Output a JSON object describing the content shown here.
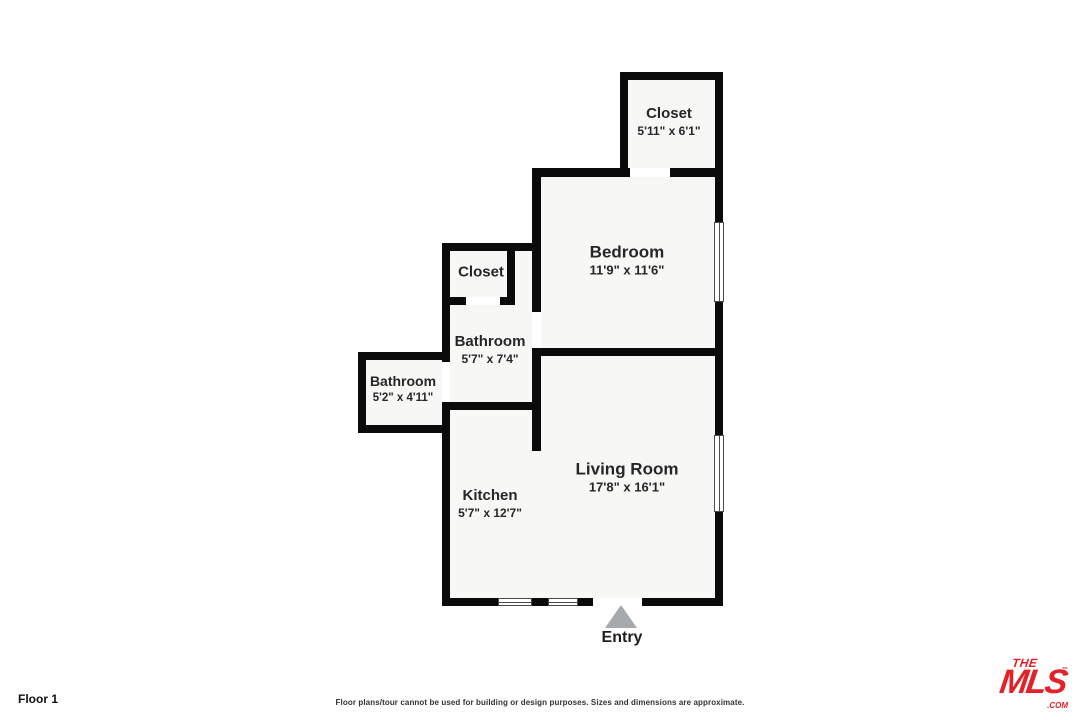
{
  "floor_label": "Floor 1",
  "disclaimer": "Floor plans/tour cannot be used for building or design purposes. Sizes and dimensions are approximate.",
  "entry": {
    "label": "Entry"
  },
  "rooms": {
    "closet_top": {
      "name": "Closet",
      "dims": "5'11\" x 6'1\""
    },
    "bedroom": {
      "name": "Bedroom",
      "dims": "11'9\" x 11'6\""
    },
    "closet_mid": {
      "name": "Closet"
    },
    "bathroom_mid": {
      "name": "Bathroom",
      "dims": "5'7\" x 7'4\""
    },
    "bathroom_left": {
      "name": "Bathroom",
      "dims": "5'2\" x 4'11\""
    },
    "living_room": {
      "name": "Living Room",
      "dims": "17'8\" x 16'1\""
    },
    "kitchen": {
      "name": "Kitchen",
      "dims": "5'7\" x 12'7\""
    }
  },
  "logo": {
    "the": "THE",
    "mls": "MLS",
    "tm": "™",
    "com": ".COM"
  },
  "colors": {
    "wall": "#0b0b0b",
    "room_fill": "#f7f7f6",
    "accent_red": "#e22128",
    "entry_arrow": "#a7aaac",
    "label_text": "#262626"
  }
}
